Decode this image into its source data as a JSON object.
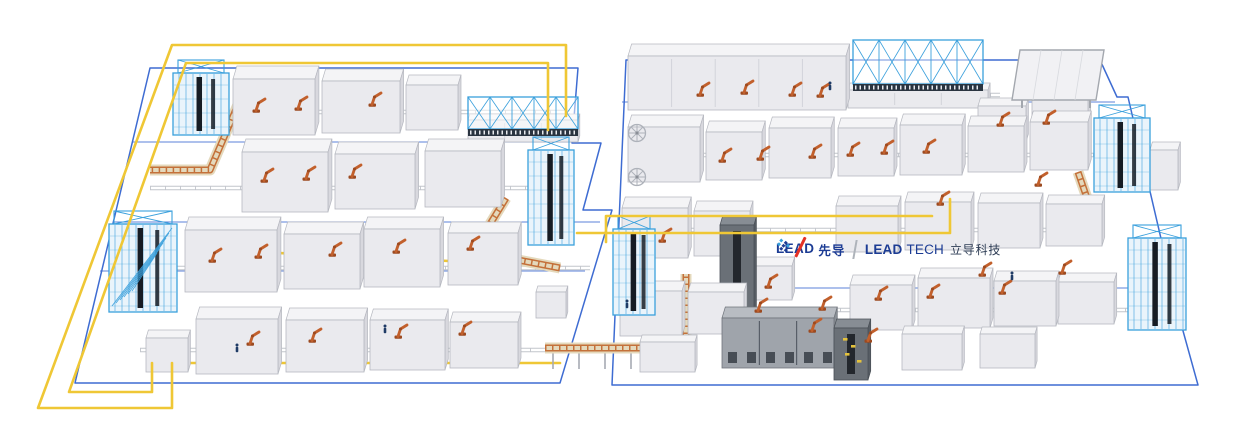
{
  "logo": {
    "lead": "LEAD",
    "lead_cn": "先导",
    "tech_bold": "LEAD",
    "tech_rest": "TECH",
    "tech_cn": "立导科技"
  },
  "colors": {
    "background": "#FFFFFF",
    "floor_blue": "#3E6CD2",
    "cable_yellow": "#EFC735",
    "rack_blue": "#3AA0DC",
    "rack_fill": "#EAF4FB",
    "rack_dark": "#161C24",
    "machine_top": "#F4F4F6",
    "machine_front": "#EAEAEE",
    "machine_side": "#D8D8DE",
    "machine_edge": "#B6B8C0",
    "dark_front": "#6A7077",
    "dark_top": "#878D94",
    "dark_side": "#575D64",
    "mid_front": "#9FA4AB",
    "mid_top": "#B8BCC2",
    "mid_side": "#8A8F96",
    "robot_orange": "#C2602C",
    "robot_base": "#9C4A20",
    "conveyor_deck": "#E4D9BC",
    "conveyor_rail": "#C4713A",
    "rail_gray": "#C2C5CC",
    "leg_gray": "#A6AAB2",
    "panel_gray": "#A3A7AE",
    "accent_yellow": "#E4C23C",
    "person_navy": "#1F3B66",
    "logo_navy": "#1C3C94",
    "logo_red": "#E53226",
    "logo_light_blue": "#35A0DC",
    "logo_cn": "#2E3D55",
    "divider_gray": "#AEB3BA"
  },
  "scene": {
    "floors": [
      {
        "name": "left-island-floor",
        "points": [
          [
            150,
            68
          ],
          [
            578,
            68
          ],
          [
            572,
            143
          ],
          [
            601,
            143
          ],
          [
            583,
            210
          ],
          [
            612,
            210
          ],
          [
            560,
            383
          ],
          [
            75,
            383
          ]
        ],
        "closed": true
      },
      {
        "name": "right-island-floor",
        "points": [
          [
            626,
            60
          ],
          [
            1100,
            60
          ],
          [
            1117,
            97
          ],
          [
            1128,
            97
          ],
          [
            1180,
            320
          ],
          [
            1198,
            385
          ],
          [
            612,
            385
          ]
        ],
        "closed": true
      }
    ],
    "floor_lines": [
      [
        [
          132,
          142
        ],
        [
          572,
          142
        ]
      ],
      [
        [
          113,
          222
        ],
        [
          600,
          222
        ]
      ],
      [
        [
          100,
          271
        ],
        [
          585,
          271
        ]
      ],
      [
        [
          622,
          102
        ],
        [
          1115,
          102
        ]
      ],
      [
        [
          616,
          288
        ],
        [
          1180,
          288
        ]
      ]
    ],
    "rails": [
      [
        [
          175,
          112
        ],
        [
          570,
          112
        ]
      ],
      [
        [
          150,
          188
        ],
        [
          560,
          188
        ]
      ],
      [
        [
          115,
          268
        ],
        [
          590,
          268
        ]
      ],
      [
        [
          140,
          350
        ],
        [
          625,
          350
        ]
      ],
      [
        [
          630,
          95
        ],
        [
          1000,
          95
        ]
      ],
      [
        [
          628,
          155
        ],
        [
          1160,
          155
        ]
      ],
      [
        [
          620,
          230
        ],
        [
          1100,
          230
        ]
      ],
      [
        [
          615,
          310
        ],
        [
          1185,
          310
        ]
      ]
    ],
    "cables_under": [
      [
        [
          193,
          232
        ],
        [
          193,
          249
        ],
        [
          470,
          262
        ]
      ],
      [
        [
          152,
          363
        ],
        [
          560,
          363
        ]
      ]
    ],
    "cables_over": [
      [
        [
          566,
          45
        ],
        [
          172,
          45
        ],
        [
          38,
          408
        ],
        [
          172,
          408
        ],
        [
          172,
          363
        ]
      ],
      [
        [
          548,
          63
        ],
        [
          186,
          63
        ],
        [
          69,
          392
        ],
        [
          152,
          392
        ],
        [
          152,
          363
        ]
      ],
      [
        [
          566,
          46
        ],
        [
          566,
          116
        ]
      ],
      [
        [
          548,
          64
        ],
        [
          548,
          130
        ]
      ],
      [
        [
          950,
          199
        ],
        [
          950,
          233
        ],
        [
          577,
          233
        ]
      ],
      [
        [
          932,
          216
        ],
        [
          606,
          216
        ],
        [
          606,
          242
        ]
      ]
    ],
    "conveyors": [
      {
        "path": [
          [
            240,
            100
          ],
          [
            210,
            170
          ],
          [
            150,
            170
          ]
        ]
      },
      {
        "path": [
          [
            506,
            198
          ],
          [
            476,
            247
          ]
        ]
      },
      {
        "path": [
          [
            476,
            252
          ],
          [
            560,
            268
          ]
        ]
      },
      {
        "path": [
          [
            545,
            348
          ],
          [
            686,
            348
          ]
        ],
        "legs": true
      },
      {
        "path": [
          [
            686,
            348
          ],
          [
            686,
            274
          ]
        ]
      },
      {
        "path": [
          [
            1078,
            172
          ],
          [
            1098,
            230
          ]
        ]
      }
    ],
    "machines": [
      [
        233,
        135,
        82,
        56,
        13
      ],
      [
        322,
        133,
        78,
        52,
        12
      ],
      [
        406,
        130,
        52,
        45,
        10
      ],
      [
        468,
        142,
        110,
        22,
        6
      ],
      [
        242,
        212,
        86,
        60,
        13
      ],
      [
        335,
        209,
        80,
        55,
        12
      ],
      [
        425,
        207,
        76,
        56,
        12
      ],
      [
        185,
        292,
        92,
        62,
        13
      ],
      [
        284,
        289,
        76,
        55,
        12
      ],
      [
        364,
        287,
        76,
        58,
        12
      ],
      [
        448,
        285,
        70,
        52,
        11
      ],
      [
        536,
        318,
        30,
        26,
        6
      ],
      [
        146,
        372,
        42,
        34,
        8
      ],
      [
        196,
        374,
        82,
        55,
        12
      ],
      [
        286,
        372,
        78,
        52,
        12
      ],
      [
        370,
        370,
        75,
        50,
        11
      ],
      [
        450,
        368,
        68,
        46,
        10
      ],
      [
        628,
        110,
        218,
        54,
        12
      ],
      [
        848,
        108,
        140,
        18,
        7
      ],
      [
        978,
        142,
        48,
        36,
        8
      ],
      [
        1032,
        140,
        56,
        40,
        9
      ],
      [
        628,
        182,
        72,
        55,
        12
      ],
      [
        706,
        180,
        56,
        48,
        11
      ],
      [
        769,
        178,
        62,
        50,
        11
      ],
      [
        838,
        176,
        56,
        48,
        10
      ],
      [
        900,
        175,
        62,
        50,
        11
      ],
      [
        968,
        172,
        56,
        46,
        10
      ],
      [
        1030,
        170,
        58,
        48,
        11
      ],
      [
        1150,
        190,
        28,
        40,
        8
      ],
      [
        622,
        258,
        66,
        50,
        11
      ],
      [
        694,
        256,
        56,
        45,
        10
      ],
      [
        836,
        252,
        62,
        46,
        10
      ],
      [
        905,
        250,
        66,
        48,
        10
      ],
      [
        978,
        248,
        62,
        45,
        10
      ],
      [
        1046,
        246,
        56,
        42,
        9
      ],
      [
        730,
        300,
        62,
        34,
        9
      ],
      [
        720,
        320,
        34,
        95,
        8,
        "dark"
      ],
      [
        620,
        336,
        62,
        45,
        10
      ],
      [
        688,
        334,
        56,
        42,
        9
      ],
      [
        850,
        330,
        62,
        45,
        10
      ],
      [
        918,
        328,
        72,
        50,
        10
      ],
      [
        994,
        326,
        62,
        45,
        10
      ],
      [
        1058,
        324,
        56,
        42,
        9
      ],
      [
        722,
        368,
        112,
        50,
        11,
        "mid"
      ],
      [
        834,
        380,
        34,
        52,
        9,
        "dark"
      ],
      [
        640,
        372,
        55,
        30,
        7
      ],
      [
        902,
        370,
        60,
        36,
        8
      ],
      [
        980,
        368,
        55,
        34,
        7
      ]
    ],
    "racks": [
      {
        "x": 173,
        "yb": 135,
        "w": 56,
        "h": 62
      },
      {
        "x": 528,
        "yb": 245,
        "w": 46,
        "h": 95
      },
      {
        "x": 109,
        "yb": 312,
        "w": 68,
        "h": 88,
        "wild": true
      },
      {
        "x": 613,
        "yb": 315,
        "w": 42,
        "h": 86
      },
      {
        "x": 1094,
        "yb": 192,
        "w": 56,
        "h": 74
      },
      {
        "x": 1128,
        "yb": 330,
        "w": 58,
        "h": 92
      }
    ],
    "trusses": [
      {
        "x": 468,
        "y": 97,
        "w": 110,
        "h": 32
      },
      {
        "x": 853,
        "y": 40,
        "w": 130,
        "h": 44
      }
    ],
    "panels": [
      {
        "points": [
          [
            1012,
            100
          ],
          [
            1020,
            50
          ],
          [
            1104,
            50
          ],
          [
            1096,
            100
          ]
        ],
        "legs": [
          [
            1022,
            100
          ],
          [
            1090,
            100
          ]
        ]
      }
    ],
    "wheels": [
      [
        637,
        133
      ],
      [
        637,
        177
      ]
    ],
    "robots": [
      [
        256,
        112
      ],
      [
        298,
        110
      ],
      [
        372,
        106
      ],
      [
        264,
        182
      ],
      [
        306,
        180
      ],
      [
        352,
        178
      ],
      [
        212,
        262
      ],
      [
        258,
        258
      ],
      [
        332,
        256
      ],
      [
        396,
        253
      ],
      [
        470,
        250
      ],
      [
        250,
        345
      ],
      [
        312,
        342
      ],
      [
        398,
        338
      ],
      [
        462,
        335
      ],
      [
        700,
        96
      ],
      [
        744,
        94
      ],
      [
        792,
        96
      ],
      [
        820,
        97
      ],
      [
        722,
        162
      ],
      [
        760,
        160
      ],
      [
        812,
        158
      ],
      [
        850,
        156
      ],
      [
        884,
        154
      ],
      [
        926,
        153
      ],
      [
        1000,
        126
      ],
      [
        1046,
        124
      ],
      [
        940,
        205
      ],
      [
        1038,
        186
      ],
      [
        662,
        242
      ],
      [
        768,
        288
      ],
      [
        758,
        312
      ],
      [
        822,
        310
      ],
      [
        878,
        300
      ],
      [
        930,
        298
      ],
      [
        1002,
        294
      ],
      [
        982,
        276
      ],
      [
        1062,
        274
      ],
      [
        812,
        332
      ],
      [
        868,
        342
      ]
    ],
    "persons": [
      [
        237,
        352
      ],
      [
        385,
        333
      ],
      [
        627,
        308
      ],
      [
        1012,
        280
      ],
      [
        830,
        90
      ]
    ],
    "accents": [
      [
        843,
        338
      ],
      [
        851,
        345
      ],
      [
        845,
        353
      ],
      [
        857,
        360
      ]
    ]
  }
}
